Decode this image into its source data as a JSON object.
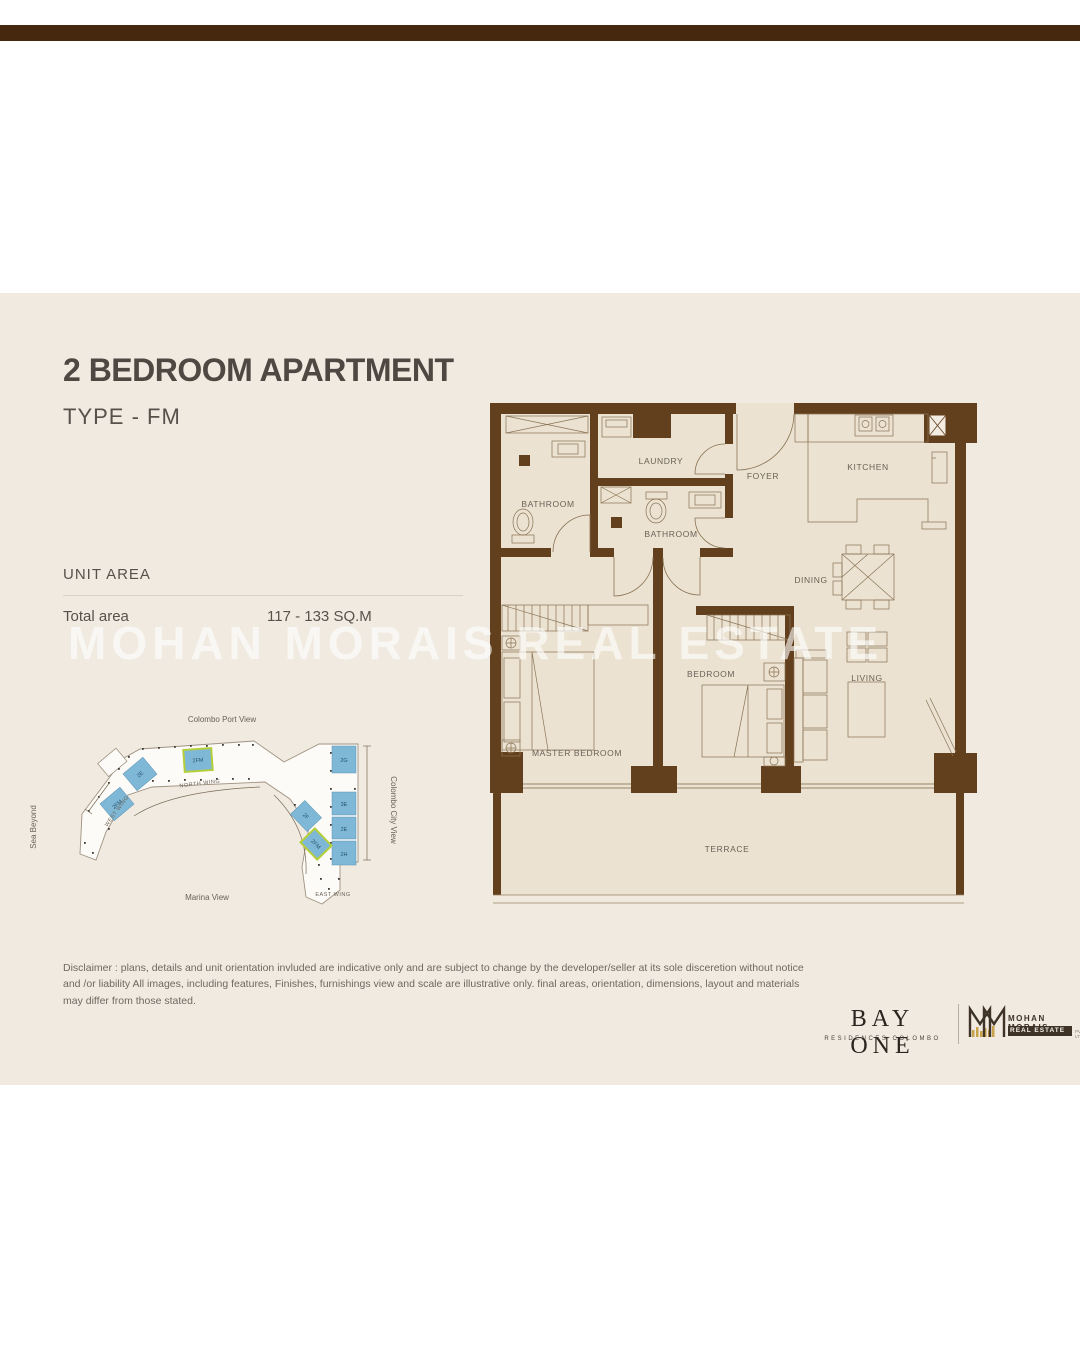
{
  "header": {
    "title": "2 BEDROOM APARTMENT",
    "subtitle": "TYPE - FM"
  },
  "unit_area": {
    "heading": "UNIT AREA",
    "label": "Total area",
    "value": "117 - 133 SQ.M"
  },
  "watermark": "MOHAN MORAIS REAL ESTATE",
  "floor_plan": {
    "rooms": {
      "bathroom1": "BATHROOM",
      "laundry": "LAUNDRY",
      "bathroom2": "BATHROOM",
      "foyer": "FOYER",
      "kitchen": "KITCHEN",
      "dining": "DINING",
      "master_bedroom": "MASTER BEDROOM",
      "bedroom": "BEDROOM",
      "living": "LIVING",
      "terrace": "TERRACE"
    }
  },
  "keyplan": {
    "views": {
      "top": "Colombo Port View",
      "left": "Sea Beyond",
      "bottom": "Marina View",
      "right": "Colombo City View"
    },
    "wings": {
      "north": "NORTH WING",
      "west": "WEST WING",
      "east": "EAST WING"
    },
    "units": [
      {
        "label": "2E"
      },
      {
        "label": "2FM"
      },
      {
        "label": "2FM"
      },
      {
        "label": "2G"
      },
      {
        "label": "3E"
      },
      {
        "label": "2E"
      },
      {
        "label": "2H"
      },
      {
        "label": "2F"
      },
      {
        "label": "2FM"
      }
    ]
  },
  "disclaimer": "Disclaimer : plans, details and unit orientation invluded are indicative only and are subject to change by the developer/seller at its sole disceretion without notice and /or liability All images, including features, Finishes, furnishings view and scale are illustrative only. final areas, orientation, dimensions, layout and materials may differ from those stated.",
  "footer": {
    "bayone_name": "BAY ONE",
    "bayone_tagline": "RESIDENCES COLOMBO",
    "mm_line1": "MOHAN MORAIS",
    "mm_line2": "REAL ESTATE",
    "mm_line3": "PVT LTD"
  },
  "colors": {
    "wall_brown": "#63401d",
    "topbar_brown": "#46280e",
    "panel_cream": "#f0eae1",
    "plan_floor": "#ebe2d2",
    "keyplan_unit_blue": "#7fb8d6",
    "highlight_green": "#b5cf3a",
    "logo_gold": "#c9a24b"
  }
}
